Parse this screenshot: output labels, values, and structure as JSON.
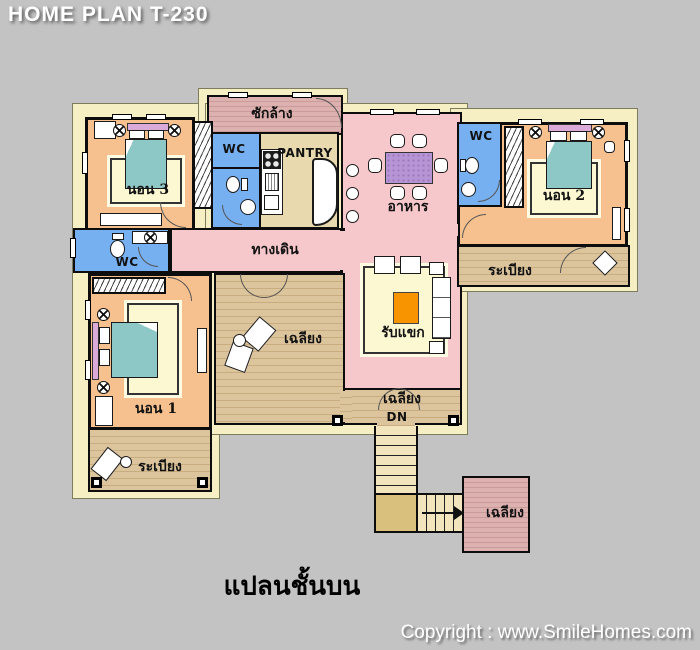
{
  "header": {
    "title": "HOME PLAN T-230"
  },
  "footer": {
    "caption": "แปลนชั้นบน",
    "copyright": "Copyright : www.SmileHomes.com"
  },
  "rooms": {
    "laundry": "ซักล้าง",
    "wc_top": "WC",
    "pantry": "PANTRY",
    "bedroom3": "นอน 3",
    "dining": "อาหาร",
    "wc_bed2": "WC",
    "bedroom2": "นอน 2",
    "corridor": "ทางเดิน",
    "balcony_right": "ระเบียง",
    "wc_left": "WC",
    "porch_center": "เฉลียง",
    "living": "รับแขก",
    "bedroom1": "นอน 1",
    "balcony_left": "ระเบียง",
    "porch_rear": "เฉลียง",
    "stairs_down": "DN",
    "porch_stairs": "เฉลียง"
  },
  "colors": {
    "background": "#c3c3c3",
    "bedroom_orange": "#f7c18f",
    "living_pink": "#f6c7cb",
    "wc_blue": "#77b0f1",
    "pantry_tan": "#e9d9ae",
    "wood_deck": "#d4bc92",
    "laundry_pink": "#d3a7a5",
    "rug_yellow": "#fcf8d2",
    "bed_teal": "#8ec8c6",
    "table_purple": "#b795d5",
    "coffee_table_orange": "#f79400",
    "eave_cream": "#f6efc3",
    "wall_black": "#0d0d0d"
  }
}
